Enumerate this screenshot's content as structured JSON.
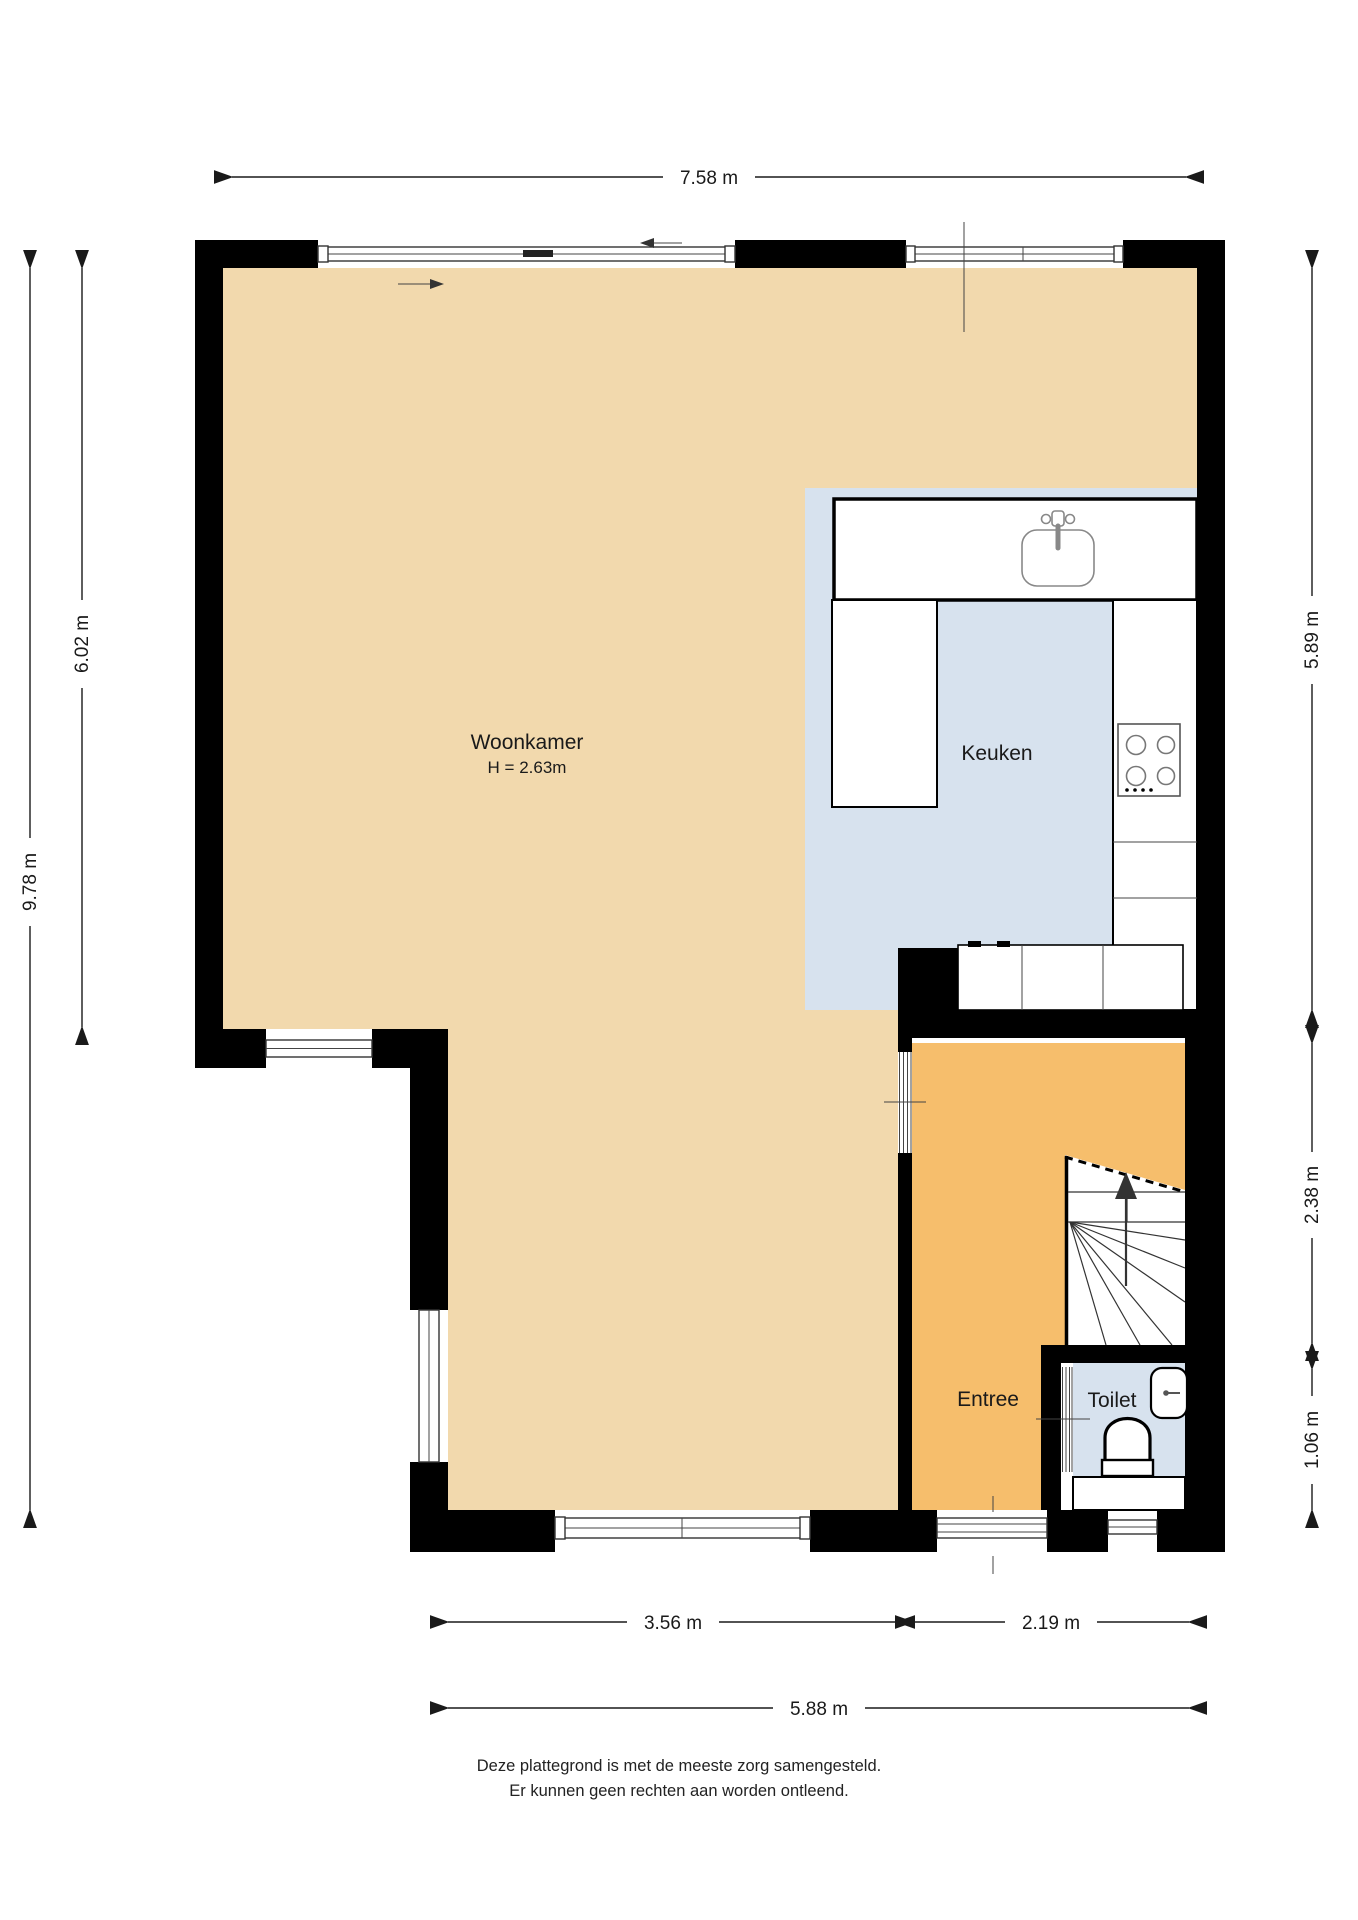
{
  "plan": {
    "rooms": {
      "woonkamer": {
        "label": "Woonkamer",
        "height_note": "H = 2.63m"
      },
      "keuken": {
        "label": "Keuken"
      },
      "entree": {
        "label": "Entree"
      },
      "toilet": {
        "label": "Toilet"
      }
    },
    "dimensions": {
      "top_width": "7.58 m",
      "left_total_height": "9.78 m",
      "left_upper_height": "6.02 m",
      "right_upper_height": "5.89 m",
      "right_middle_height": "2.38 m",
      "right_lower_height": "1.06 m",
      "bottom_left_width": "3.56 m",
      "bottom_right_width": "2.19 m",
      "bottom_total_width": "5.88 m"
    },
    "fixtures": {
      "kitchen_sink": "sink-icon",
      "stove": "stove-4-burner-icon",
      "toilet_bowl": "toilet-icon",
      "toilet_basin": "hand-basin-icon",
      "stairs": "stairs-up-icon",
      "stairs_direction": "up"
    },
    "colors": {
      "floor_living": "#F2D9AD",
      "floor_kitchen": "#D7E2EE",
      "floor_entry": "#F6BE6C",
      "floor_toilet": "#D7E2EE",
      "wall": "#000000",
      "dimension": "#1A1A1A"
    }
  },
  "footer": {
    "line1": "Deze plattegrond is met de meeste zorg samengesteld.",
    "line2": "Er kunnen geen rechten aan worden ontleend."
  }
}
